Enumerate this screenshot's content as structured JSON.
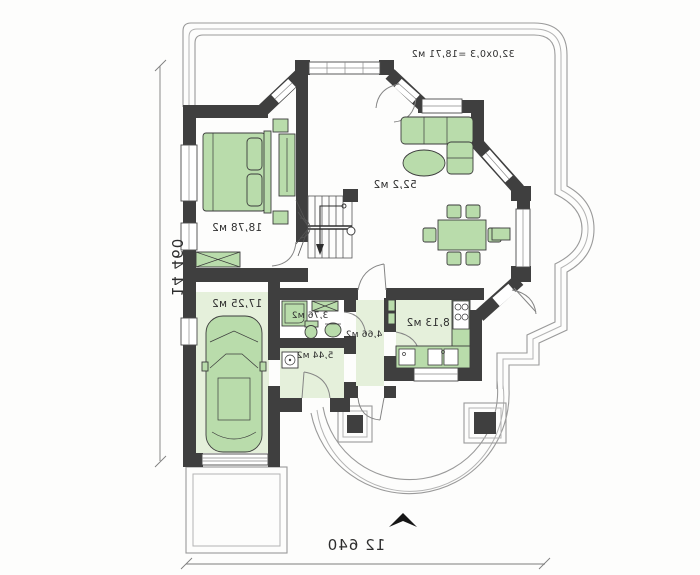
{
  "document": {
    "type": "architectural floor plan, ground floor, horizontally mirrored print",
    "orientation": "mirrored"
  },
  "rooms": [
    {
      "id": "living-dining",
      "area_label": "52,2 м2"
    },
    {
      "id": "bedroom",
      "area_label": "18,78 м2"
    },
    {
      "id": "garage",
      "area_label": "17,25 м2"
    },
    {
      "id": "kitchen",
      "area_label": "8,13 м2"
    },
    {
      "id": "entry-hall",
      "area_label": "5,44 м2"
    },
    {
      "id": "corridor",
      "area_label": "4,66 м2"
    },
    {
      "id": "bathroom",
      "area_label": "3,76 м2"
    }
  ],
  "annotations": {
    "terrace_note": "32,0x0,3 =18,71 м2"
  },
  "dimensions": {
    "overall_width_bottom": "12 640",
    "overall_depth_left": "14 460"
  },
  "colors": {
    "walls": "#3f3f3f",
    "furniture": "#b9dcab",
    "floor_tint": "#e5f0db",
    "terrace_outline": "#9a9a9a",
    "background": "#fdfdfc"
  }
}
